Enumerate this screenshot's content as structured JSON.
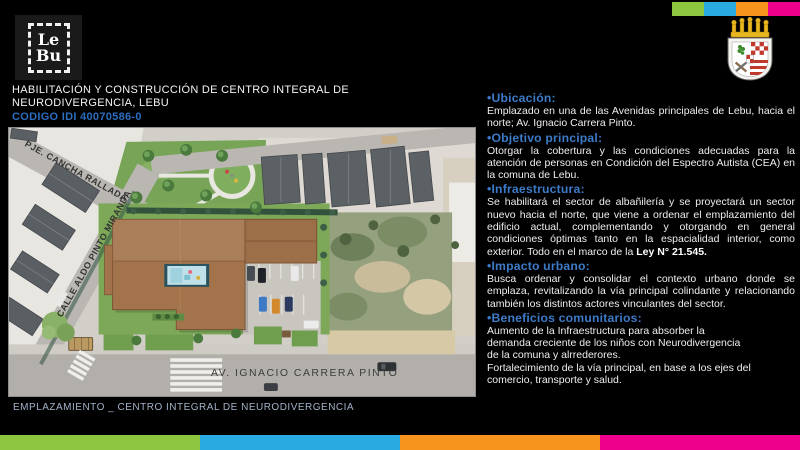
{
  "slide": {
    "logo_line1": "Le",
    "logo_line2": "Bu",
    "title_line1": "HABILITACIÓN Y CONSTRUCCIÓN DE CENTRO INTEGRAL DE",
    "title_line2": "NEURODIVERGENCIA, LEBU",
    "project_code": "CODIGO IDI 40070586-0",
    "map_caption": "EMPLAZAMIENTO _ CENTRO INTEGRAL DE NEURODIVERGENCIA"
  },
  "map": {
    "street_top": "PJE. CANCHA RALLADA",
    "street_left": "CALLE ALDO PINTO MIRANDA",
    "avenue": "AV. IGNACIO CARRERA PINTO"
  },
  "sections": [
    {
      "heading": "•Ubicación:",
      "body": "Emplazado en una de las Avenidas principales de Lebu, hacia el norte; Av. Ignacio Carrera Pinto."
    },
    {
      "heading": "•Objetivo principal:",
      "body": "Otorgar la cobertura y las condiciones adecuadas para la atención de personas en Condición del Espectro Autista (CEA) en la comuna de Lebu."
    },
    {
      "heading": "•Infraestructura:",
      "body": "Se habilitará el sector de albañilería y se proyectará un sector nuevo hacia el norte, que viene a ordenar el emplazamiento del edificio actual, complementando y otorgando en general condiciones óptimas tanto en la espacialidad interior, como exterior. Todo en el marco de la ",
      "body_bold": "Ley N° 21.545."
    },
    {
      "heading": "•Impacto urbano:",
      "body": "Busca ordenar y consolidar el contexto urbano donde se emplaza, revitalizando la vía principal colindante y relacionando también los distintos actores vinculantes del sector."
    },
    {
      "heading": "•Beneficios comunitarios:",
      "body": "Aumento de la Infraestructura para absorber la\ndemanda creciente de los niños con Neurodivergencia\nde la comuna y alrrederores.\nFortalecimiento de la vía principal, en base a los ejes del\ncomercio, transporte y salud."
    }
  ],
  "colors": {
    "accent_green": "#8CC63F",
    "accent_blue": "#29ABE2",
    "accent_orange": "#F7941D",
    "accent_pink": "#EC008C",
    "heading_blue": "#3D7BC8",
    "code_blue": "#2D6EC0",
    "caption_blue": "#A3B2C9"
  }
}
